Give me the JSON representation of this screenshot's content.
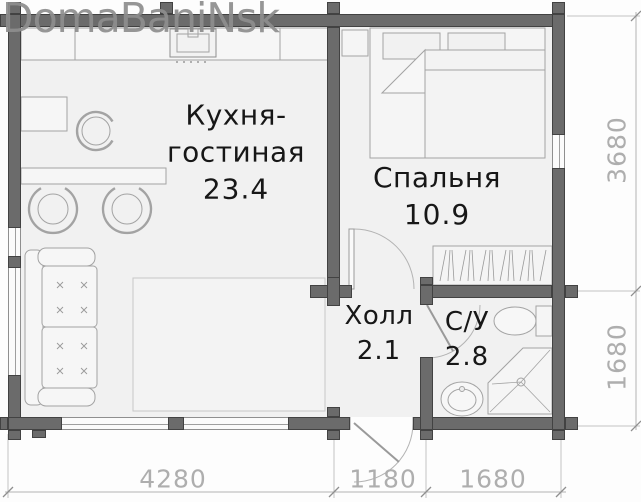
{
  "watermark": {
    "text": "DomaBaniNsk"
  },
  "rooms": {
    "kitchen_living": {
      "name_line1": "Кухня-",
      "name_line2": "гостиная",
      "area": "23.4"
    },
    "bedroom": {
      "name": "Спальня",
      "area": "10.9"
    },
    "hall": {
      "name": "Холл",
      "area": "2.1"
    },
    "bathroom": {
      "name": "С/У",
      "area": "2.8"
    }
  },
  "dimensions": {
    "bottom": [
      {
        "label": "4280"
      },
      {
        "label": "1180"
      },
      {
        "label": "1680"
      }
    ],
    "right": [
      {
        "label": "3680"
      },
      {
        "label": "1680"
      }
    ]
  },
  "colors": {
    "wall": "#6b6b6b",
    "floor": "#f1f1f1",
    "furniture_line": "#a3a3a3",
    "label_text": "#171717",
    "dimension_text": "#aeaeae",
    "watermark": "#8e8e8e"
  }
}
